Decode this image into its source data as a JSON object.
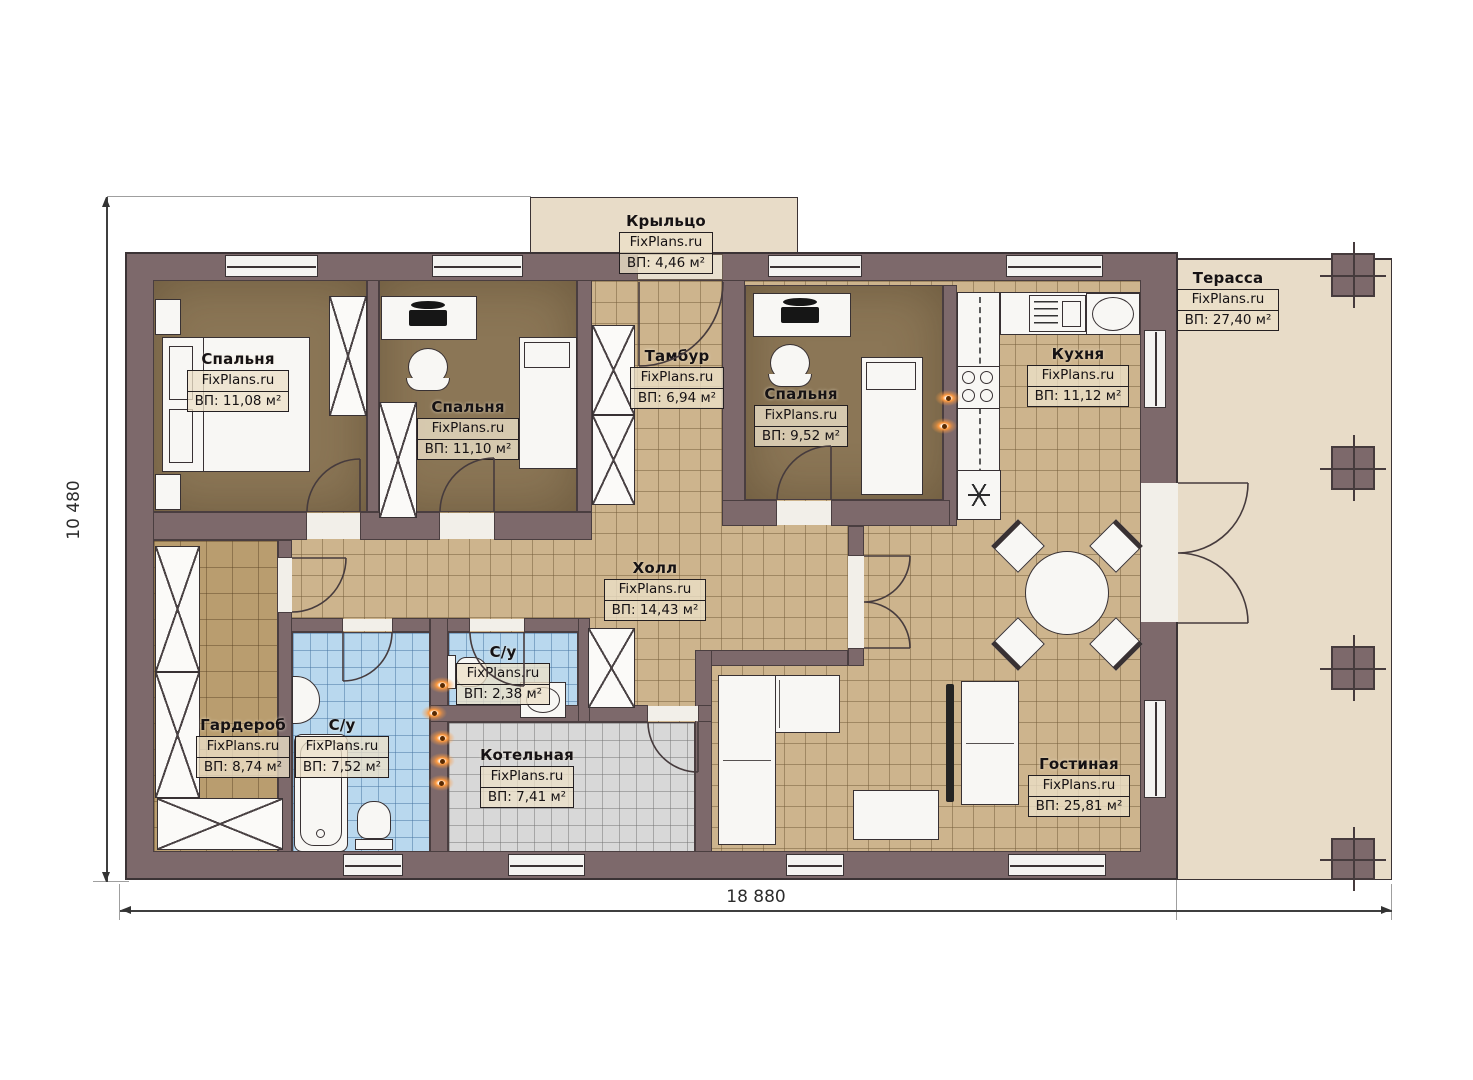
{
  "brand": "FixPlans.ru",
  "dimensions": {
    "width_total": "18 880",
    "height_total": "10 480"
  },
  "rooms": {
    "porch": {
      "name": "Крыльцо",
      "area": "ВП: 4,46 м²"
    },
    "bedroom1": {
      "name": "Спальня",
      "area": "ВП: 11,08 м²"
    },
    "bedroom2": {
      "name": "Спальня",
      "area": "ВП: 11,10 м²"
    },
    "tambour": {
      "name": "Тамбур",
      "area": "ВП: 6,94 м²"
    },
    "bedroom3": {
      "name": "Спальня",
      "area": "ВП: 9,52 м²"
    },
    "kitchen": {
      "name": "Кухня",
      "area": "ВП: 11,12 м²"
    },
    "terrace": {
      "name": "Терасса",
      "area": "ВП: 27,40 м²"
    },
    "hall": {
      "name": "Холл",
      "area": "ВП: 14,43 м²"
    },
    "wardrobe": {
      "name": "Гардероб",
      "area": "ВП: 8,74 м²"
    },
    "bathroom_main": {
      "name": "С/у",
      "area": "ВП: 7,52 м²"
    },
    "bathroom_small": {
      "name": "С/у",
      "area": "ВП: 2,38 м²"
    },
    "boiler": {
      "name": "Котельная",
      "area": "ВП: 7,41 м²"
    },
    "living": {
      "name": "Гостиная",
      "area": "ВП: 25,81 м²"
    }
  },
  "colors": {
    "wall": "#7d696b",
    "tile_floor": "#cdb48d",
    "bedroom_floor": "#8b7656",
    "bathroom_tile": "#b9d8ee",
    "boiler_tile": "#d8d8d8",
    "wardrobe_floor": "#b99d6f",
    "terrace_floor": "#e8dcc8",
    "utility_marker": "#ff9a3e"
  }
}
